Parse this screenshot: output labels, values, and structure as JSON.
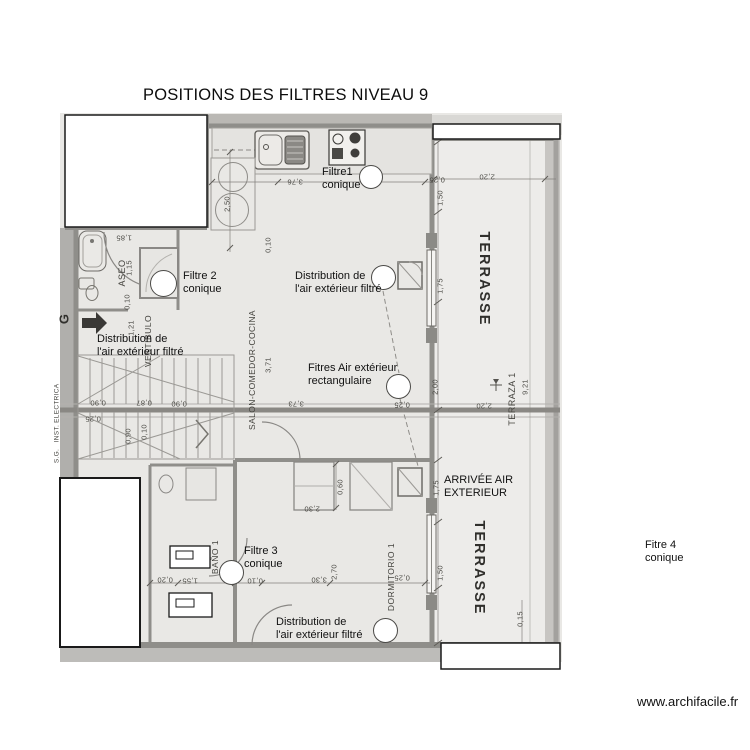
{
  "title": "POSITIONS DES FILTRES  NIVEAU 9",
  "watermark": "www.archifacile.fr",
  "annotations": [
    {
      "id": "filtre-1",
      "x": 322,
      "y": 166,
      "lines": [
        "Filtre1",
        "conique"
      ]
    },
    {
      "id": "filtre-2",
      "x": 183,
      "y": 270,
      "lines": [
        "Filtre 2",
        "conique"
      ]
    },
    {
      "id": "distribution-vestibule",
      "x": 97,
      "y": 333,
      "lines": [
        "Distribution de",
        "l'air extérieur filtré"
      ]
    },
    {
      "id": "distribution-salon",
      "x": 295,
      "y": 270,
      "lines": [
        "Distribution de",
        "l'air extérieur filtré"
      ]
    },
    {
      "id": "filtres-rectangulaires",
      "x": 308,
      "y": 362,
      "lines": [
        "Fitres Air extérieur",
        "rectangulaire"
      ]
    },
    {
      "id": "arrivee-air",
      "x": 444,
      "y": 474,
      "lines": [
        "ARRIVÉE AIR",
        "EXTERIEUR"
      ]
    },
    {
      "id": "filtre-3",
      "x": 244,
      "y": 545,
      "lines": [
        "Filtre 3",
        "conique"
      ]
    },
    {
      "id": "distribution-dormitorio",
      "x": 276,
      "y": 616,
      "lines": [
        "Distribution de",
        "l'air extérieur filtré"
      ]
    },
    {
      "id": "filtre-4",
      "x": 645,
      "y": 539,
      "lines": [
        "Fitre 4",
        "conique"
      ]
    }
  ],
  "filter_markers": [
    {
      "cx": 371,
      "cy": 177,
      "r": 12
    },
    {
      "cx": 163,
      "cy": 283,
      "r": 13.5
    },
    {
      "cx": 383,
      "cy": 277,
      "r": 12.5
    },
    {
      "cx": 398,
      "cy": 386,
      "r": 12.5
    },
    {
      "cx": 231,
      "cy": 572,
      "r": 12.5
    },
    {
      "cx": 385,
      "cy": 630,
      "r": 12.5
    }
  ],
  "plan": {
    "room_labels": [
      {
        "t": "ASEO",
        "x": 122,
        "y": 273,
        "r": -90,
        "s": 9,
        "ls": 0.5
      },
      {
        "t": "VESTIBULO",
        "x": 148,
        "y": 341,
        "r": -90,
        "s": 8.5,
        "ls": 0.5
      },
      {
        "t": "SALON-COMEDOR-COCINA",
        "x": 252,
        "y": 370,
        "r": -90,
        "s": 8.5,
        "ls": 0.4
      },
      {
        "t": "BAÑO 1",
        "x": 215,
        "y": 557,
        "r": -90,
        "s": 8.5,
        "ls": 0.5
      },
      {
        "t": "DORMITORIO 1",
        "x": 391,
        "y": 577,
        "r": -90,
        "s": 8.5,
        "ls": 0.5
      },
      {
        "t": "TERRAZA 1",
        "x": 512,
        "y": 399,
        "r": -90,
        "s": 9,
        "ls": 0.5
      },
      {
        "t": "TERRASSE",
        "x": 484,
        "y": 279,
        "r": 90,
        "s": 14.5,
        "ls": 2,
        "b": 1
      },
      {
        "t": "TERRASSE",
        "x": 479,
        "y": 568,
        "r": 90,
        "s": 14.5,
        "ls": 2,
        "b": 1
      },
      {
        "t": "G",
        "x": 64,
        "y": 319,
        "r": -90,
        "s": 13,
        "b": 1
      },
      {
        "t": "INST. ELECTRICA",
        "x": 57,
        "y": 413,
        "r": -90,
        "s": 6.5,
        "ls": 0.3
      },
      {
        "t": "S.G.",
        "x": 57,
        "y": 456,
        "r": -90,
        "s": 6.5,
        "ls": 0.3
      }
    ],
    "dimensions": [
      {
        "t": "3,76",
        "x": 295,
        "y": 182,
        "r": 180
      },
      {
        "t": "0,25",
        "x": 437,
        "y": 180,
        "r": 180
      },
      {
        "t": "2,20",
        "x": 487,
        "y": 177,
        "r": 180
      },
      {
        "t": "2,50",
        "x": 227,
        "y": 204,
        "r": -90
      },
      {
        "t": "1,50",
        "x": 440,
        "y": 198,
        "r": -90
      },
      {
        "t": "1,85",
        "x": 124,
        "y": 238,
        "r": 180
      },
      {
        "t": "0,10",
        "x": 268,
        "y": 245,
        "r": -90
      },
      {
        "t": "1,15",
        "x": 129,
        "y": 268,
        "r": -90
      },
      {
        "t": "1,75",
        "x": 440,
        "y": 286,
        "r": -90
      },
      {
        "t": "0,10",
        "x": 127,
        "y": 302,
        "r": -90
      },
      {
        "t": "1,21",
        "x": 131,
        "y": 328,
        "r": -90
      },
      {
        "t": "3,71",
        "x": 268,
        "y": 365,
        "r": -90
      },
      {
        "t": "2,00",
        "x": 435,
        "y": 387,
        "r": -90
      },
      {
        "t": "9,21",
        "x": 525,
        "y": 387,
        "r": -90
      },
      {
        "t": "0,90",
        "x": 98,
        "y": 403,
        "r": 180
      },
      {
        "t": "0,87",
        "x": 144,
        "y": 403,
        "r": 180
      },
      {
        "t": "0,90",
        "x": 179,
        "y": 404,
        "r": 180
      },
      {
        "t": "3,73",
        "x": 296,
        "y": 404,
        "r": 180
      },
      {
        "t": "0,25",
        "x": 402,
        "y": 405,
        "r": 180
      },
      {
        "t": "2,20",
        "x": 484,
        "y": 406,
        "r": 180
      },
      {
        "t": "0,25",
        "x": 93,
        "y": 419,
        "r": 180
      },
      {
        "t": "0,90",
        "x": 128,
        "y": 436,
        "r": -90
      },
      {
        "t": "0,10",
        "x": 144,
        "y": 432,
        "r": -90
      },
      {
        "t": "0,60",
        "x": 340,
        "y": 487,
        "r": -90
      },
      {
        "t": "1,75",
        "x": 436,
        "y": 488,
        "r": -90
      },
      {
        "t": "2,30",
        "x": 312,
        "y": 509,
        "r": 180
      },
      {
        "t": "2,70",
        "x": 334,
        "y": 572,
        "r": -90
      },
      {
        "t": "1,50",
        "x": 440,
        "y": 573,
        "r": -90
      },
      {
        "t": "0,25",
        "x": 402,
        "y": 578,
        "r": 180
      },
      {
        "t": "0,20",
        "x": 165,
        "y": 580,
        "r": 180
      },
      {
        "t": "1,55",
        "x": 190,
        "y": 581,
        "r": 180
      },
      {
        "t": "0,10",
        "x": 255,
        "y": 581,
        "r": 180
      },
      {
        "t": "3,30",
        "x": 319,
        "y": 580,
        "r": 180
      },
      {
        "t": "0,15",
        "x": 520,
        "y": 619,
        "r": -90
      }
    ]
  }
}
